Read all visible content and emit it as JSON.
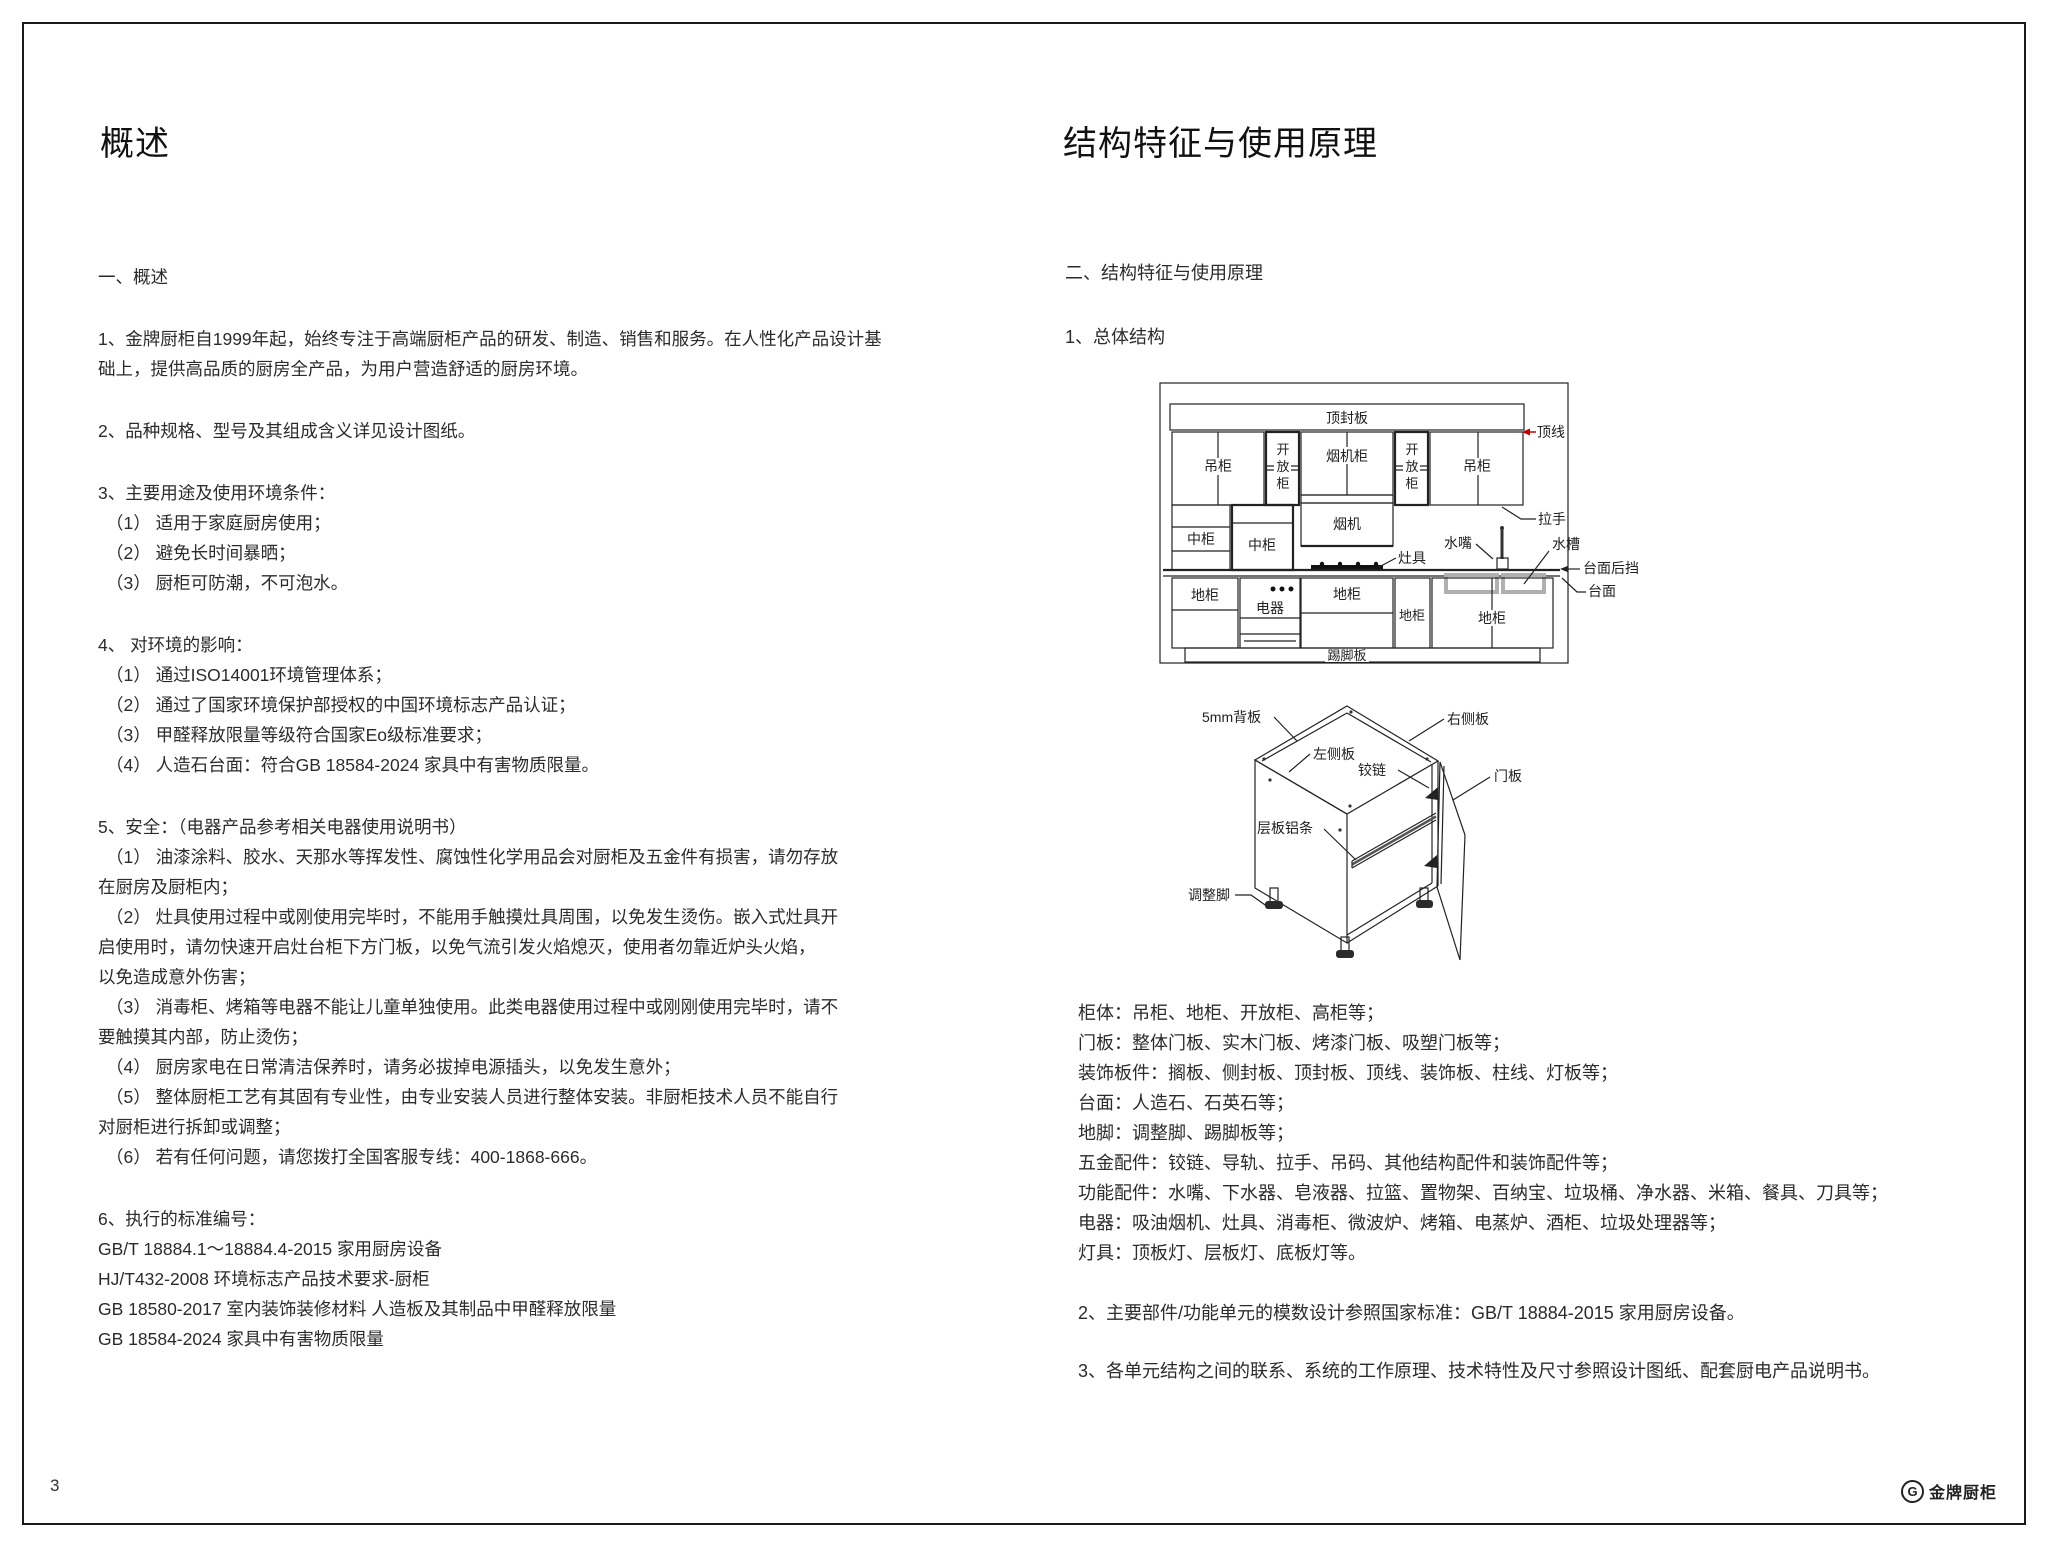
{
  "page": {
    "number": "3",
    "brand": "金牌厨柜",
    "brand_mark": "G"
  },
  "colors": {
    "accent_red": "#c00000",
    "line": "#222222",
    "sink_gray": "#b0b0b0"
  },
  "left": {
    "title": "概述",
    "blocks": [
      {
        "lines": [
          "一、概述"
        ]
      },
      {
        "lines": [
          "1、金牌厨柜自1999年起，始终专注于高端厨柜产品的研发、制造、销售和服务。在人性化产品设计基",
          "础上，提供高品质的厨房全产品，为用户营造舒适的厨房环境。"
        ]
      },
      {
        "lines": [
          "2、品种规格、型号及其组成含义详见设计图纸。"
        ]
      },
      {
        "lines": [
          "3、主要用途及使用环境条件：",
          "（1） 适用于家庭厨房使用；",
          "（2） 避免长时间暴晒；",
          "（3） 厨柜可防潮，不可泡水。"
        ]
      },
      {
        "lines": [
          "4、 对环境的影响：",
          "（1） 通过ISO14001环境管理体系；",
          "（2） 通过了国家环境保护部授权的中国环境标志产品认证；",
          "（3） 甲醛释放限量等级符合国家Eo级标准要求；",
          "（4） 人造石台面：符合GB 18584-2024 家具中有害物质限量。"
        ]
      },
      {
        "lines": [
          "5、安全：（电器产品参考相关电器使用说明书）",
          "（1） 油漆涂料、胶水、天那水等挥发性、腐蚀性化学用品会对厨柜及五金件有损害，请勿存放",
          "在厨房及厨柜内；",
          "（2） 灶具使用过程中或刚使用完毕时，不能用手触摸灶具周围，以免发生烫伤。嵌入式灶具开",
          "启使用时，请勿快速开启灶台柜下方门板，以免气流引发火焰熄灭，使用者勿靠近炉头火焰，",
          "以免造成意外伤害；",
          "（3） 消毒柜、烤箱等电器不能让儿童单独使用。此类电器使用过程中或刚刚使用完毕时，请不",
          "要触摸其内部，防止烫伤；",
          "（4） 厨房家电在日常清洁保养时，请务必拔掉电源插头，以免发生意外；",
          "（5） 整体厨柜工艺有其固有专业性，由专业安装人员进行整体安装。非厨柜技术人员不能自行",
          "对厨柜进行拆卸或调整；",
          "（6） 若有任何问题，请您拨打全国客服专线：400-1868-666。"
        ]
      },
      {
        "lines": [
          "6、执行的标准编号：",
          "GB/T 18884.1～18884.4-2015 家用厨房设备",
          "HJ/T432-2008 环境标志产品技术要求-厨柜",
          "GB 18580-2017 室内装饰装修材料 人造板及其制品中甲醛释放限量",
          "GB 18584-2024 家具中有害物质限量"
        ]
      }
    ]
  },
  "right": {
    "title": "结构特征与使用原理",
    "heading": "二、结构特征与使用原理",
    "sub1": "1、总体结构",
    "diagram1": {
      "labels": {
        "top_panel": "顶封板",
        "crown": "顶线",
        "wall_cab": "吊柜",
        "open_chars": [
          "开",
          "放",
          "柜"
        ],
        "hood_cab": "烟机柜",
        "handle": "拉手",
        "mid_cab": "中柜",
        "hood": "烟机",
        "cooktop": "灶具",
        "faucet": "水嘴",
        "sink": "水槽",
        "backsplash": "台面后挡",
        "countertop": "台面",
        "base_cab": "地柜",
        "appliance": "电器",
        "toe_kick": "踢脚板"
      }
    },
    "diagram2": {
      "labels": {
        "back_panel": "5mm背板",
        "right_side": "右侧板",
        "left_side": "左侧板",
        "hinge": "铰链",
        "door": "门板",
        "shelf_strip": "层板铝条",
        "leveler": "调整脚"
      }
    },
    "components": [
      "柜体：吊柜、地柜、开放柜、高柜等；",
      "门板：整体门板、实木门板、烤漆门板、吸塑门板等；",
      "装饰板件：搁板、侧封板、顶封板、顶线、装饰板、柱线、灯板等；",
      "台面：人造石、石英石等；",
      "地脚：调整脚、踢脚板等；",
      "五金配件：铰链、导轨、拉手、吊码、其他结构配件和装饰配件等；",
      "功能配件：水嘴、下水器、皂液器、拉篮、置物架、百纳宝、垃圾桶、净水器、米箱、餐具、刀具等；",
      "电器：吸油烟机、灶具、消毒柜、微波炉、烤箱、电蒸炉、酒柜、垃圾处理器等；",
      "灯具：顶板灯、层板灯、底板灯等。"
    ],
    "para2": "2、主要部件/功能单元的模数设计参照国家标准：GB/T 18884-2015 家用厨房设备。",
    "para3": "3、各单元结构之间的联系、系统的工作原理、技术特性及尺寸参照设计图纸、配套厨电产品说明书。"
  }
}
